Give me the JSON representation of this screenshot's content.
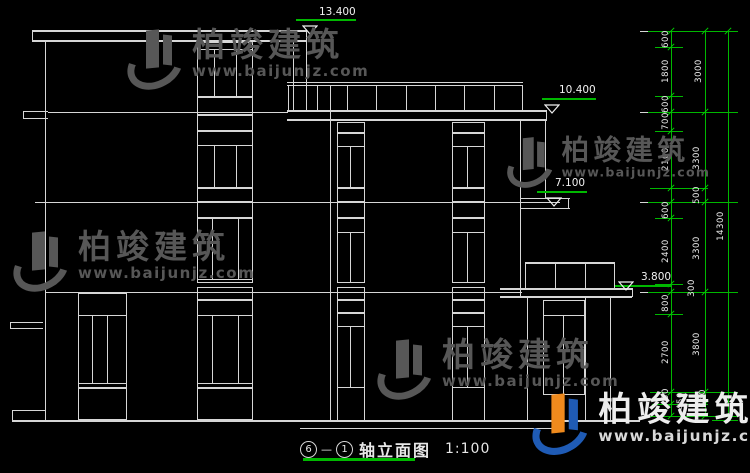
{
  "title": {
    "axis_start": "6",
    "axis_end": "1",
    "dash": "—",
    "name": "轴立面图",
    "scale": "1:100"
  },
  "watermark": {
    "cn": "柏竣建筑",
    "url": "www.baijunjz.com"
  },
  "colors": {
    "line": "#d6d6d6",
    "dimension_green": "#00b800",
    "marker_green": "#00d000",
    "watermark_grey": "#575757",
    "logo_blue": "#1f5bb5",
    "logo_orange": "#ef8a1d"
  },
  "elevation_levels": [
    {
      "value": "13.400",
      "tx": 319,
      "ty": 7,
      "lx": 296,
      "ly": 19,
      "lw": 60,
      "trix": 302,
      "triy": 20
    },
    {
      "value": "10.400",
      "tx": 559,
      "ty": 85,
      "lx": 542,
      "ly": 98,
      "lw": 54,
      "trix": 544,
      "triy": 99
    },
    {
      "value": "7.100",
      "tx": 555,
      "ty": 178,
      "lx": 537,
      "ly": 191,
      "lw": 50,
      "trix": 546,
      "triy": 192
    },
    {
      "value": "3.800",
      "tx": 641,
      "ty": 272,
      "lx": 615,
      "ly": 285,
      "lw": 56,
      "trix": 618,
      "triy": 276
    }
  ],
  "dimensions": {
    "chain_small": [
      "600",
      "1800",
      "600",
      "700",
      "2100",
      "500",
      "600",
      "2400",
      "300",
      "800",
      "2700",
      "450",
      "450"
    ],
    "chain_floor": [
      "3000",
      "3300",
      "3300",
      "3800",
      "450",
      "450"
    ],
    "chain_total": [
      "14300"
    ],
    "labels": [
      {
        "t": "600",
        "x": 666,
        "y": 39
      },
      {
        "t": "1800",
        "x": 666,
        "y": 71
      },
      {
        "t": "600",
        "x": 666,
        "y": 104
      },
      {
        "t": "700",
        "x": 666,
        "y": 121
      },
      {
        "t": "2100",
        "x": 666,
        "y": 159
      },
      {
        "t": "500",
        "x": 697,
        "y": 195
      },
      {
        "t": "600",
        "x": 666,
        "y": 210
      },
      {
        "t": "2400",
        "x": 666,
        "y": 251
      },
      {
        "t": "300",
        "x": 692,
        "y": 288
      },
      {
        "t": "800",
        "x": 666,
        "y": 303
      },
      {
        "t": "2700",
        "x": 666,
        "y": 352
      },
      {
        "t": "450",
        "x": 666,
        "y": 397
      },
      {
        "t": "450",
        "x": 681,
        "y": 401
      },
      {
        "t": "3000",
        "x": 699,
        "y": 71
      },
      {
        "t": "3300",
        "x": 697,
        "y": 158
      },
      {
        "t": "3300",
        "x": 697,
        "y": 248
      },
      {
        "t": "3800",
        "x": 697,
        "y": 344
      },
      {
        "t": "450",
        "x": 703,
        "y": 398
      },
      {
        "t": "14300",
        "x": 721,
        "y": 226
      }
    ],
    "ticks": [
      {
        "x": 671,
        "ys": [
          31,
          47,
          96,
          112,
          131,
          188,
          202,
          218,
          284,
          292,
          314,
          392,
          404,
          416
        ]
      },
      {
        "x": 705,
        "ys": [
          31,
          112,
          188,
          202,
          292,
          392,
          404,
          416
        ]
      },
      {
        "x": 728,
        "ys": [
          31,
          420
        ]
      }
    ],
    "green_v": [
      [
        671,
        31,
        385
      ],
      [
        705,
        31,
        385
      ],
      [
        728,
        31,
        389
      ]
    ],
    "green_h": [
      [
        648,
        31,
        90
      ],
      [
        655,
        47,
        28
      ],
      [
        655,
        96,
        28
      ],
      [
        648,
        112,
        90
      ],
      [
        655,
        131,
        28
      ],
      [
        650,
        188,
        58
      ],
      [
        648,
        202,
        90
      ],
      [
        655,
        218,
        28
      ],
      [
        655,
        284,
        28
      ],
      [
        648,
        292,
        90
      ],
      [
        655,
        314,
        28
      ],
      [
        650,
        392,
        88
      ],
      [
        652,
        404,
        56
      ],
      [
        650,
        416,
        88
      ],
      [
        712,
        420,
        26
      ]
    ]
  },
  "drawing": {
    "white_h": [
      [
        32,
        30,
        274,
        2
      ],
      [
        32,
        40,
        274,
        2
      ],
      [
        23,
        111,
        25,
        1
      ],
      [
        23,
        118,
        25,
        1
      ],
      [
        48,
        112,
        240,
        1
      ],
      [
        287,
        110,
        260,
        2
      ],
      [
        287,
        119,
        260,
        2
      ],
      [
        287,
        82,
        236,
        1
      ],
      [
        287,
        85,
        236,
        1
      ],
      [
        35,
        202,
        525,
        1
      ],
      [
        45,
        292,
        477,
        1
      ],
      [
        10,
        322,
        33,
        1
      ],
      [
        10,
        328,
        33,
        1
      ],
      [
        12,
        410,
        33,
        1
      ],
      [
        12,
        420,
        628,
        2
      ],
      [
        300,
        428,
        260,
        1
      ],
      [
        500,
        288,
        132,
        2
      ],
      [
        500,
        296,
        132,
        2
      ],
      [
        525,
        262,
        90,
        2
      ],
      [
        520,
        198,
        50,
        1
      ],
      [
        520,
        208,
        50,
        1
      ],
      [
        197,
        49,
        56,
        1
      ],
      [
        197,
        145,
        56,
        1
      ],
      [
        197,
        279,
        56,
        1
      ],
      [
        197,
        315,
        56,
        1
      ],
      [
        197,
        383,
        56,
        1
      ],
      [
        78,
        315,
        49,
        1
      ],
      [
        78,
        383,
        49,
        1
      ],
      [
        337,
        146,
        28,
        1
      ],
      [
        337,
        232,
        28,
        1
      ],
      [
        337,
        326,
        28,
        1
      ],
      [
        452,
        146,
        33,
        1
      ],
      [
        452,
        232,
        33,
        1
      ],
      [
        452,
        326,
        33,
        1
      ],
      [
        543,
        315,
        42,
        1
      ],
      [
        640,
        31,
        10,
        1
      ],
      [
        640,
        112,
        10,
        1
      ],
      [
        640,
        202,
        10,
        1
      ],
      [
        640,
        292,
        10,
        1
      ]
    ],
    "white_v": [
      [
        45,
        40,
        381,
        1
      ],
      [
        32,
        30,
        12,
        1
      ],
      [
        23,
        111,
        8,
        1
      ],
      [
        10,
        322,
        7,
        1
      ],
      [
        12,
        410,
        11,
        1
      ],
      [
        330,
        85,
        336,
        1
      ],
      [
        293,
        40,
        70,
        1
      ],
      [
        306,
        30,
        81,
        1
      ],
      [
        520,
        121,
        175,
        1
      ],
      [
        545,
        121,
        77,
        1
      ],
      [
        546,
        110,
        10,
        1
      ],
      [
        568,
        198,
        11,
        1
      ],
      [
        527,
        296,
        125,
        1
      ],
      [
        585,
        296,
        125,
        1
      ],
      [
        610,
        296,
        125,
        1
      ],
      [
        632,
        288,
        9,
        1
      ],
      [
        288,
        85,
        25,
        1
      ],
      [
        317,
        85,
        25,
        1
      ],
      [
        347,
        85,
        25,
        1
      ],
      [
        376,
        85,
        25,
        1
      ],
      [
        406,
        85,
        25,
        1
      ],
      [
        435,
        85,
        25,
        1
      ],
      [
        464,
        85,
        25,
        1
      ],
      [
        494,
        85,
        25,
        1
      ],
      [
        522,
        85,
        25,
        1
      ],
      [
        525,
        262,
        26,
        1
      ],
      [
        555,
        262,
        26,
        1
      ],
      [
        585,
        262,
        26,
        1
      ],
      [
        614,
        262,
        26,
        1
      ],
      [
        214,
        49,
        48,
        1
      ],
      [
        236,
        49,
        48,
        1
      ],
      [
        214,
        145,
        43,
        1
      ],
      [
        236,
        145,
        43,
        1
      ],
      [
        212,
        218,
        61,
        1
      ],
      [
        238,
        218,
        61,
        1
      ],
      [
        212,
        315,
        68,
        1
      ],
      [
        238,
        315,
        68,
        1
      ],
      [
        92,
        315,
        68,
        1
      ],
      [
        107,
        315,
        68,
        1
      ],
      [
        350,
        146,
        42,
        1
      ],
      [
        350,
        232,
        51,
        1
      ],
      [
        350,
        326,
        62,
        1
      ],
      [
        467,
        146,
        42,
        1
      ],
      [
        467,
        232,
        51,
        1
      ],
      [
        467,
        326,
        62,
        1
      ],
      [
        563,
        315,
        80,
        1
      ],
      [
        337,
        388,
        32,
        1
      ],
      [
        364,
        388,
        32,
        1
      ],
      [
        452,
        388,
        32,
        1
      ],
      [
        484,
        388,
        32,
        1
      ]
    ],
    "rects": [
      [
        197,
        42,
        56,
        55
      ],
      [
        197,
        97,
        56,
        18
      ],
      [
        197,
        115,
        56,
        16
      ],
      [
        197,
        131,
        56,
        57
      ],
      [
        197,
        188,
        56,
        14
      ],
      [
        197,
        202,
        56,
        16
      ],
      [
        197,
        218,
        56,
        65
      ],
      [
        197,
        287,
        56,
        13
      ],
      [
        197,
        300,
        56,
        88
      ],
      [
        197,
        388,
        56,
        32
      ],
      [
        78,
        293,
        49,
        95
      ],
      [
        78,
        388,
        49,
        32
      ],
      [
        337,
        122,
        28,
        11
      ],
      [
        337,
        133,
        28,
        55
      ],
      [
        337,
        188,
        28,
        14
      ],
      [
        337,
        202,
        28,
        16
      ],
      [
        337,
        218,
        28,
        65
      ],
      [
        337,
        287,
        28,
        13
      ],
      [
        337,
        300,
        28,
        13
      ],
      [
        337,
        313,
        28,
        75
      ],
      [
        452,
        122,
        33,
        11
      ],
      [
        452,
        133,
        33,
        55
      ],
      [
        452,
        188,
        33,
        14
      ],
      [
        452,
        202,
        33,
        16
      ],
      [
        452,
        218,
        33,
        65
      ],
      [
        452,
        287,
        33,
        13
      ],
      [
        452,
        300,
        33,
        13
      ],
      [
        452,
        313,
        33,
        75
      ],
      [
        543,
        300,
        42,
        95
      ]
    ]
  },
  "watermarks": [
    {
      "x": 126,
      "y": 28,
      "scale": 1,
      "bright": false
    },
    {
      "x": 506,
      "y": 136,
      "scale": 0.84,
      "bright": false
    },
    {
      "x": 12,
      "y": 230,
      "scale": 1,
      "bright": false
    },
    {
      "x": 376,
      "y": 338,
      "scale": 1,
      "bright": false
    },
    {
      "x": 531,
      "y": 392,
      "scale": 1.02,
      "bright": true
    }
  ],
  "title_underline": [
    303,
    458,
    112,
    3
  ]
}
